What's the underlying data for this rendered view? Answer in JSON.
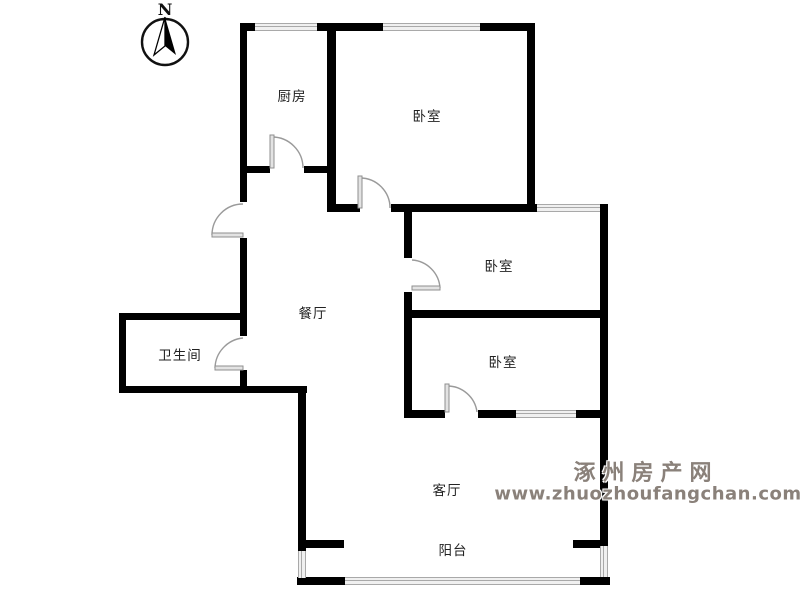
{
  "compass": {
    "north_label": "N"
  },
  "rooms": {
    "kitchen": {
      "label": "厨房"
    },
    "bedroom_1": {
      "label": "卧室"
    },
    "bedroom_2": {
      "label": "卧室"
    },
    "bedroom_3": {
      "label": "卧室"
    },
    "dining": {
      "label": "餐厅"
    },
    "bathroom": {
      "label": "卫生间"
    },
    "living": {
      "label": "客厅"
    },
    "balcony": {
      "label": "阳台"
    }
  },
  "watermark": {
    "site_name": "涿州房产网",
    "site_url": "www.zhuozhoufangchan.com",
    "color": "#8a817a"
  },
  "colors": {
    "wall": "#000000",
    "window_line": "#a9a9a9",
    "door_arc": "#9a9a9a",
    "label_text": "#222222",
    "background": "#ffffff"
  }
}
